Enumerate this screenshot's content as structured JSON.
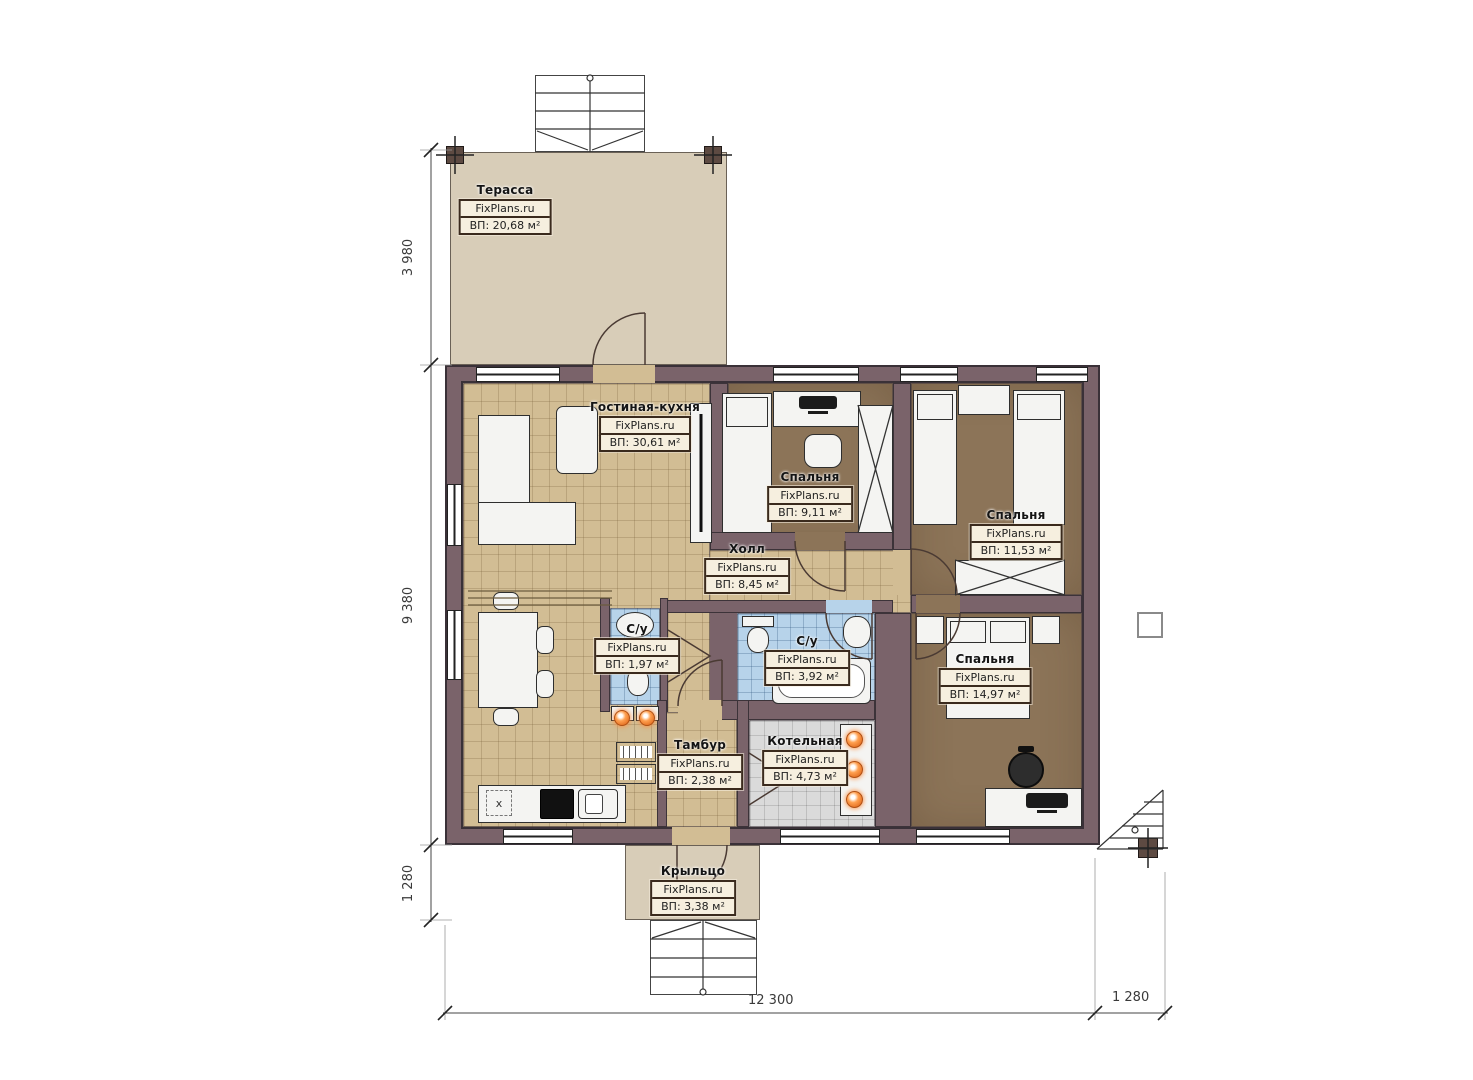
{
  "watermark": "FixPlans.ru",
  "plan_title": "План одноэтажного дома",
  "rooms": [
    {
      "id": "terrace",
      "name": "Терасса",
      "area": "ВП: 20,68 м²"
    },
    {
      "id": "living",
      "name": "Гостиная-кухня",
      "area": "ВП: 30,61 м²"
    },
    {
      "id": "bedroom1",
      "name": "Спальня",
      "area": "ВП: 9,11 м²"
    },
    {
      "id": "bedroom2",
      "name": "Спальня",
      "area": "ВП: 11,53 м²"
    },
    {
      "id": "hall",
      "name": "Холл",
      "area": "ВП: 8,45 м²"
    },
    {
      "id": "wc1",
      "name": "С/у",
      "area": "ВП: 1,97 м²"
    },
    {
      "id": "wc2",
      "name": "С/у",
      "area": "ВП: 3,92 м²"
    },
    {
      "id": "bedroom3",
      "name": "Спальня",
      "area": "ВП: 14,97 м²"
    },
    {
      "id": "tambour",
      "name": "Тамбур",
      "area": "ВП: 2,38 м²"
    },
    {
      "id": "boiler",
      "name": "Котельная",
      "area": "ВП: 4,73 м²"
    },
    {
      "id": "porch",
      "name": "Крыльцо",
      "area": "ВП: 3,38 м²"
    }
  ],
  "dimensions": {
    "left_top": "3 980",
    "left_middle": "9 380",
    "left_bottom": "1 280",
    "bottom_main": "12 300",
    "bottom_right": "1 280"
  },
  "kitchen": {
    "marker_label": "x"
  },
  "colors": {
    "wall": "#7a636a",
    "wall_outline": "#3a3138",
    "floor_tan": "#d2bd94",
    "floor_brown": "#8c7458",
    "tile_blue": "#b7d3ea",
    "tile_gray": "#dadada",
    "terrace_beige": "#d8cdb8",
    "label_border": "#3a2a1d",
    "label_bg": "#f6efdf",
    "radiator_orange": "#e06a1e"
  }
}
